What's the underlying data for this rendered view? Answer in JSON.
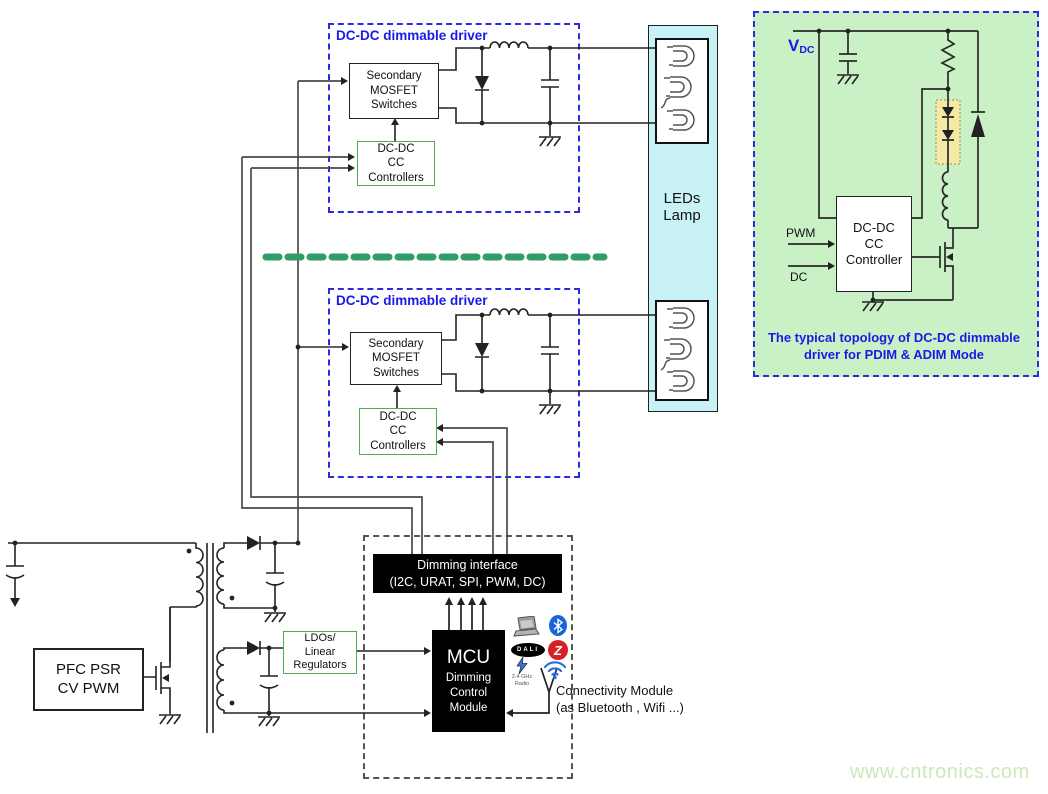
{
  "colors": {
    "accent_blue": "#1a1ae6",
    "frame_blue": "#2b2bdf",
    "green_border": "#4cae4c",
    "panel_bg": "#caf0c6",
    "lamp_bg": "#c9f2f6",
    "separator_green": "#2e9d68",
    "led_window_yellow": "#f5e9a8",
    "watermark_green": "#cde9b5",
    "wire": "#444444"
  },
  "driver_top": {
    "title": "DC-DC dimmable  driver",
    "mosfet": "Secondary\nMOSFET\nSwitches",
    "controller": "DC-DC\nCC\nControllers"
  },
  "driver_bottom": {
    "title": "DC-DC dimmable  driver",
    "mosfet": "Secondary\nMOSFET\nSwitches",
    "controller": "DC-DC\nCC\nControllers"
  },
  "lamp": {
    "label": "LEDs\nLamp"
  },
  "panel": {
    "vdc_main": "V",
    "vdc_sub": "DC",
    "pwm": "PWM",
    "dc": "DC",
    "controller": "DC-DC\nCC\nController",
    "caption": "The typical topology of DC-DC dimmable\ndriver for PDIM  & ADIM Mode"
  },
  "power": {
    "pfc": "PFC PSR\nCV PWM",
    "ldo": "LDOs/\nLinear\nRegulators"
  },
  "control": {
    "dimming_line1": "Dimming interface",
    "dimming_line2": "(I2C, URAT, SPI, PWM, DC)",
    "mcu_title": "MCU",
    "mcu_subtitle": "Dimming\nControl\nModule",
    "connectivity": "Connectivity Module\n(as Bluetooth , Wifi ...)"
  },
  "icons": {
    "dali": "DALI",
    "zigbee": "Z",
    "radio": "2.4 GHz\nRadio"
  },
  "watermark": "www.cntronics.com"
}
